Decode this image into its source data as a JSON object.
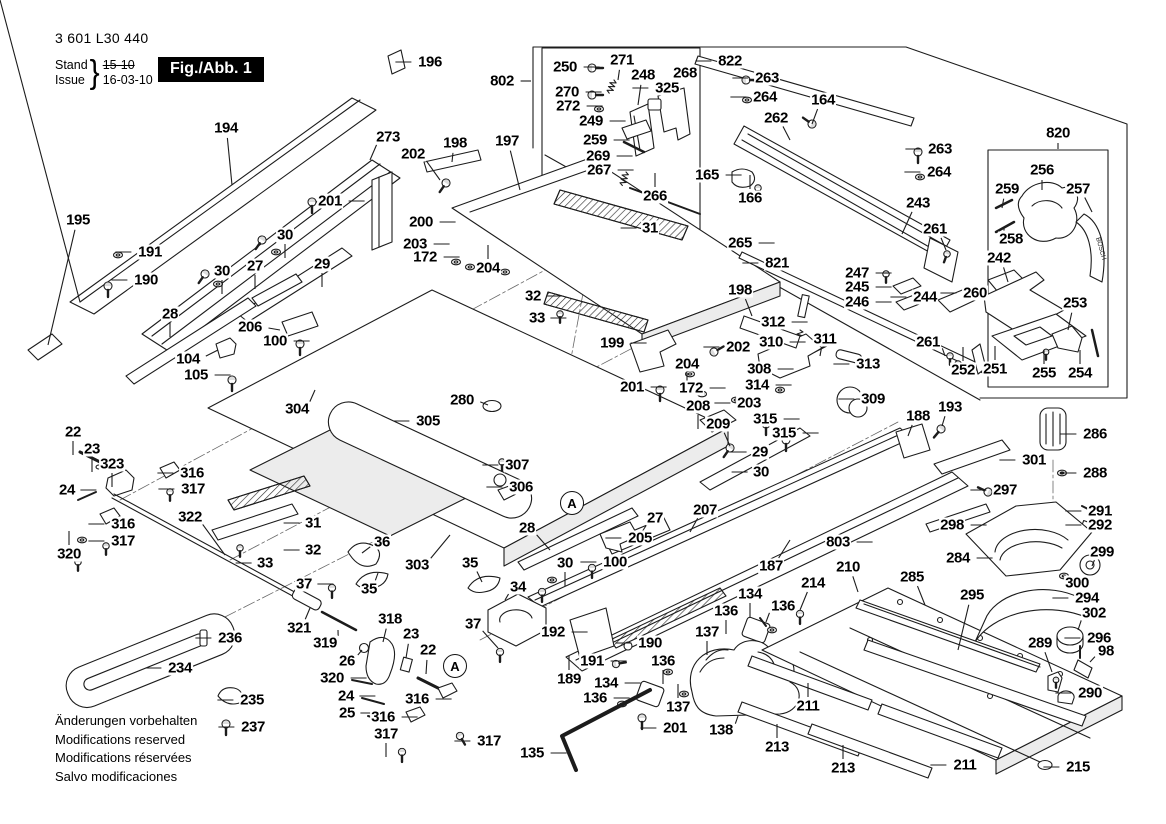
{
  "header": {
    "part_number": "3 601 L30 440",
    "stand_label": "Stand",
    "issue_label": "Issue",
    "brace": "}",
    "stand_value": "15-10",
    "issue_value": "16-03-10",
    "figure_label": "Fig./Abb. 1"
  },
  "footer": {
    "line1": "Änderungen vorbehalten",
    "line2": "Modifications reserved",
    "line3": "Modifications réservées",
    "line4": "Salvo modificaciones"
  },
  "handle_brand": "BOSCH",
  "detail_markers": [
    {
      "t": "A",
      "x": 572,
      "y": 503
    },
    {
      "t": "A",
      "x": 455,
      "y": 666
    }
  ],
  "callouts": [
    {
      "t": "194",
      "x": 226,
      "y": 128,
      "lx": 232,
      "ly": 185
    },
    {
      "t": "273",
      "x": 388,
      "y": 137,
      "lx": 370,
      "ly": 160
    },
    {
      "t": "195",
      "x": 78,
      "y": 220,
      "lx": 48,
      "ly": 345
    },
    {
      "t": "191",
      "x": 150,
      "y": 252,
      "d": "l"
    },
    {
      "t": "190",
      "x": 146,
      "y": 280,
      "d": "l"
    },
    {
      "t": "196",
      "x": 430,
      "y": 62,
      "d": "l"
    },
    {
      "t": "202",
      "x": 413,
      "y": 154,
      "lx": 440,
      "ly": 180
    },
    {
      "t": "198",
      "x": 455,
      "y": 143,
      "lx": 452,
      "ly": 162
    },
    {
      "t": "197",
      "x": 507,
      "y": 141,
      "lx": 520,
      "ly": 190
    },
    {
      "t": "802",
      "x": 502,
      "y": 81,
      "lx": 531,
      "ly": 81
    },
    {
      "t": "201",
      "x": 330,
      "y": 201,
      "d": "r"
    },
    {
      "t": "30",
      "x": 285,
      "y": 235,
      "d": "d"
    },
    {
      "t": "27",
      "x": 255,
      "y": 266,
      "d": "d"
    },
    {
      "t": "29",
      "x": 322,
      "y": 264,
      "d": "d"
    },
    {
      "t": "200",
      "x": 421,
      "y": 222,
      "d": "r"
    },
    {
      "t": "203",
      "x": 415,
      "y": 244,
      "d": "r"
    },
    {
      "t": "172",
      "x": 425,
      "y": 257,
      "d": "r"
    },
    {
      "t": "204",
      "x": 488,
      "y": 268,
      "d": "u"
    },
    {
      "t": "30",
      "x": 222,
      "y": 271,
      "d": "d"
    },
    {
      "t": "28",
      "x": 170,
      "y": 314,
      "d": "d"
    },
    {
      "t": "206",
      "x": 250,
      "y": 327,
      "lx": 280,
      "ly": 330
    },
    {
      "t": "100",
      "x": 275,
      "y": 341,
      "d": "r"
    },
    {
      "t": "104",
      "x": 188,
      "y": 359,
      "lx": 218,
      "ly": 350
    },
    {
      "t": "105",
      "x": 196,
      "y": 375,
      "d": "r"
    },
    {
      "t": "304",
      "x": 297,
      "y": 409,
      "lx": 315,
      "ly": 390
    },
    {
      "t": "305",
      "x": 428,
      "y": 421,
      "d": "l"
    },
    {
      "t": "280",
      "x": 462,
      "y": 400,
      "lx": 488,
      "ly": 405
    },
    {
      "t": "307",
      "x": 517,
      "y": 465,
      "d": "l"
    },
    {
      "t": "306",
      "x": 521,
      "y": 487,
      "d": "l"
    },
    {
      "t": "303",
      "x": 417,
      "y": 565,
      "lx": 450,
      "ly": 535
    },
    {
      "t": "322",
      "x": 190,
      "y": 517,
      "lx": 225,
      "ly": 555
    },
    {
      "t": "323",
      "x": 112,
      "y": 464,
      "d": "d"
    },
    {
      "t": "22",
      "x": 73,
      "y": 432,
      "d": "d"
    },
    {
      "t": "23",
      "x": 92,
      "y": 449,
      "d": "d"
    },
    {
      "t": "24",
      "x": 67,
      "y": 490,
      "d": "r"
    },
    {
      "t": "316",
      "x": 192,
      "y": 473,
      "d": "l"
    },
    {
      "t": "317",
      "x": 193,
      "y": 489,
      "d": "l"
    },
    {
      "t": "316",
      "x": 123,
      "y": 524,
      "d": "l"
    },
    {
      "t": "317",
      "x": 123,
      "y": 541,
      "d": "l"
    },
    {
      "t": "320",
      "x": 69,
      "y": 554,
      "d": "u"
    },
    {
      "t": "31",
      "x": 313,
      "y": 523,
      "d": "l"
    },
    {
      "t": "32",
      "x": 313,
      "y": 550,
      "d": "l"
    },
    {
      "t": "33",
      "x": 265,
      "y": 563,
      "d": "l"
    },
    {
      "t": "36",
      "x": 382,
      "y": 542,
      "lx": 362,
      "ly": 553
    },
    {
      "t": "35",
      "x": 369,
      "y": 589,
      "lx": 378,
      "ly": 573
    },
    {
      "t": "37",
      "x": 304,
      "y": 584,
      "d": "r"
    },
    {
      "t": "321",
      "x": 299,
      "y": 628,
      "lx": 310,
      "ly": 608
    },
    {
      "t": "319",
      "x": 325,
      "y": 643,
      "lx": 338,
      "ly": 630
    },
    {
      "t": "26",
      "x": 347,
      "y": 661,
      "lx": 362,
      "ly": 650
    },
    {
      "t": "318",
      "x": 390,
      "y": 619,
      "lx": 383,
      "ly": 642
    },
    {
      "t": "23",
      "x": 411,
      "y": 634,
      "lx": 406,
      "ly": 658
    },
    {
      "t": "22",
      "x": 428,
      "y": 650,
      "lx": 426,
      "ly": 674
    },
    {
      "t": "320",
      "x": 332,
      "y": 678,
      "d": "r"
    },
    {
      "t": "24",
      "x": 346,
      "y": 696,
      "d": "r"
    },
    {
      "t": "25",
      "x": 347,
      "y": 713,
      "d": "r"
    },
    {
      "t": "316",
      "x": 417,
      "y": 699,
      "d": "r"
    },
    {
      "t": "316",
      "x": 383,
      "y": 717,
      "d": "r"
    },
    {
      "t": "317",
      "x": 386,
      "y": 734,
      "d": "d"
    },
    {
      "t": "317",
      "x": 489,
      "y": 741,
      "d": "l"
    },
    {
      "t": "37",
      "x": 473,
      "y": 624,
      "lx": 498,
      "ly": 648
    },
    {
      "t": "236",
      "x": 230,
      "y": 638,
      "d": "l"
    },
    {
      "t": "234",
      "x": 180,
      "y": 668,
      "d": "l"
    },
    {
      "t": "235",
      "x": 252,
      "y": 700,
      "d": "l"
    },
    {
      "t": "237",
      "x": 253,
      "y": 727,
      "d": "l"
    },
    {
      "t": "34",
      "x": 518,
      "y": 587,
      "lx": 505,
      "ly": 600
    },
    {
      "t": "35",
      "x": 470,
      "y": 563,
      "lx": 482,
      "ly": 582
    },
    {
      "t": "192",
      "x": 553,
      "y": 632,
      "d": "r"
    },
    {
      "t": "190",
      "x": 650,
      "y": 643,
      "d": "l"
    },
    {
      "t": "191",
      "x": 592,
      "y": 661,
      "d": "r"
    },
    {
      "t": "189",
      "x": 569,
      "y": 679,
      "d": "u"
    },
    {
      "t": "135",
      "x": 532,
      "y": 753,
      "d": "r"
    },
    {
      "t": "134",
      "x": 606,
      "y": 683,
      "d": "r"
    },
    {
      "t": "136",
      "x": 595,
      "y": 698,
      "d": "r"
    },
    {
      "t": "137",
      "x": 678,
      "y": 707,
      "d": "u"
    },
    {
      "t": "201",
      "x": 675,
      "y": 728,
      "d": "l"
    },
    {
      "t": "136",
      "x": 663,
      "y": 661,
      "d": "d"
    },
    {
      "t": "138",
      "x": 721,
      "y": 730,
      "lx": 738,
      "ly": 716
    },
    {
      "t": "134",
      "x": 750,
      "y": 594,
      "d": "d"
    },
    {
      "t": "136",
      "x": 783,
      "y": 606,
      "lx": 766,
      "ly": 622
    },
    {
      "t": "136",
      "x": 726,
      "y": 611,
      "d": "d"
    },
    {
      "t": "137",
      "x": 707,
      "y": 632,
      "d": "d"
    },
    {
      "t": "28",
      "x": 527,
      "y": 528,
      "lx": 550,
      "ly": 550
    },
    {
      "t": "205",
      "x": 640,
      "y": 538,
      "d": "l"
    },
    {
      "t": "27",
      "x": 655,
      "y": 518,
      "lx": 640,
      "ly": 535
    },
    {
      "t": "100",
      "x": 615,
      "y": 562,
      "d": "l"
    },
    {
      "t": "30",
      "x": 565,
      "y": 563,
      "d": "d"
    },
    {
      "t": "207",
      "x": 705,
      "y": 510,
      "lx": 690,
      "ly": 532
    },
    {
      "t": "187",
      "x": 771,
      "y": 566,
      "lx": 790,
      "ly": 540
    },
    {
      "t": "803",
      "x": 838,
      "y": 542,
      "d": "r"
    },
    {
      "t": "210",
      "x": 848,
      "y": 567,
      "lx": 858,
      "ly": 592
    },
    {
      "t": "214",
      "x": 813,
      "y": 583,
      "lx": 800,
      "ly": 610
    },
    {
      "t": "211",
      "x": 808,
      "y": 706,
      "d": "u"
    },
    {
      "t": "213",
      "x": 777,
      "y": 747,
      "d": "u"
    },
    {
      "t": "213",
      "x": 843,
      "y": 768,
      "d": "u"
    },
    {
      "t": "211",
      "x": 965,
      "y": 765,
      "d": "l"
    },
    {
      "t": "215",
      "x": 1078,
      "y": 767,
      "d": "l"
    },
    {
      "t": "285",
      "x": 912,
      "y": 577,
      "lx": 925,
      "ly": 605
    },
    {
      "t": "295",
      "x": 972,
      "y": 595,
      "lx": 958,
      "ly": 650
    },
    {
      "t": "284",
      "x": 958,
      "y": 558,
      "d": "r"
    },
    {
      "t": "297",
      "x": 1005,
      "y": 490,
      "d": "l"
    },
    {
      "t": "298",
      "x": 952,
      "y": 525,
      "d": "r"
    },
    {
      "t": "291",
      "x": 1100,
      "y": 511,
      "d": "l"
    },
    {
      "t": "292",
      "x": 1100,
      "y": 525,
      "d": "l"
    },
    {
      "t": "299",
      "x": 1102,
      "y": 552,
      "lx": 1092,
      "ly": 566
    },
    {
      "t": "300",
      "x": 1077,
      "y": 583,
      "lx": 1068,
      "ly": 576
    },
    {
      "t": "294",
      "x": 1087,
      "y": 598,
      "d": "l"
    },
    {
      "t": "302",
      "x": 1094,
      "y": 613,
      "lx": 1078,
      "ly": 630
    },
    {
      "t": "296",
      "x": 1099,
      "y": 638,
      "d": "l"
    },
    {
      "t": "98",
      "x": 1106,
      "y": 651,
      "lx": 1090,
      "ly": 662
    },
    {
      "t": "289",
      "x": 1040,
      "y": 643,
      "lx": 1052,
      "ly": 672
    },
    {
      "t": "290",
      "x": 1090,
      "y": 693,
      "d": "l"
    },
    {
      "t": "286",
      "x": 1095,
      "y": 434,
      "d": "l"
    },
    {
      "t": "288",
      "x": 1095,
      "y": 473,
      "d": "l"
    },
    {
      "t": "301",
      "x": 1034,
      "y": 460,
      "d": "l"
    },
    {
      "t": "188",
      "x": 918,
      "y": 416,
      "lx": 908,
      "ly": 436
    },
    {
      "t": "193",
      "x": 950,
      "y": 407,
      "lx": 942,
      "ly": 426
    },
    {
      "t": "308",
      "x": 759,
      "y": 369,
      "d": "r"
    },
    {
      "t": "314",
      "x": 757,
      "y": 385,
      "d": "r"
    },
    {
      "t": "312",
      "x": 773,
      "y": 322,
      "d": "r"
    },
    {
      "t": "310",
      "x": 771,
      "y": 342,
      "d": "r"
    },
    {
      "t": "311",
      "x": 825,
      "y": 339,
      "lx": 820,
      "ly": 356
    },
    {
      "t": "313",
      "x": 868,
      "y": 364,
      "d": "l"
    },
    {
      "t": "309",
      "x": 873,
      "y": 399,
      "d": "l"
    },
    {
      "t": "315",
      "x": 765,
      "y": 419,
      "d": "r"
    },
    {
      "t": "315",
      "x": 784,
      "y": 433,
      "d": "r"
    },
    {
      "t": "29",
      "x": 760,
      "y": 452,
      "d": "l"
    },
    {
      "t": "30",
      "x": 761,
      "y": 472,
      "d": "l"
    },
    {
      "t": "203",
      "x": 749,
      "y": 403,
      "d": "l"
    },
    {
      "t": "202",
      "x": 738,
      "y": 347,
      "d": "l"
    },
    {
      "t": "198",
      "x": 740,
      "y": 290,
      "lx": 752,
      "ly": 316
    },
    {
      "t": "208",
      "x": 698,
      "y": 406,
      "d": "d"
    },
    {
      "t": "209",
      "x": 718,
      "y": 424,
      "lx": 730,
      "ly": 446
    },
    {
      "t": "201",
      "x": 632,
      "y": 387,
      "d": "r"
    },
    {
      "t": "204",
      "x": 687,
      "y": 364,
      "d": "d"
    },
    {
      "t": "172",
      "x": 691,
      "y": 388,
      "d": "r"
    },
    {
      "t": "199",
      "x": 612,
      "y": 343,
      "d": "r"
    },
    {
      "t": "31",
      "x": 650,
      "y": 228,
      "d": "l"
    },
    {
      "t": "32",
      "x": 533,
      "y": 296,
      "d": "r"
    },
    {
      "t": "33",
      "x": 537,
      "y": 318,
      "d": "r"
    },
    {
      "t": "265",
      "x": 740,
      "y": 243,
      "d": "r"
    },
    {
      "t": "821",
      "x": 777,
      "y": 263,
      "d": "l"
    },
    {
      "t": "822",
      "x": 730,
      "y": 61,
      "d": "l"
    },
    {
      "t": "263",
      "x": 767,
      "y": 78,
      "d": "l"
    },
    {
      "t": "264",
      "x": 765,
      "y": 97,
      "d": "l"
    },
    {
      "t": "164",
      "x": 823,
      "y": 100,
      "lx": 812,
      "ly": 124
    },
    {
      "t": "262",
      "x": 776,
      "y": 118,
      "lx": 790,
      "ly": 140
    },
    {
      "t": "263",
      "x": 940,
      "y": 149,
      "d": "l"
    },
    {
      "t": "264",
      "x": 939,
      "y": 172,
      "d": "l"
    },
    {
      "t": "243",
      "x": 918,
      "y": 203,
      "lx": 902,
      "ly": 234
    },
    {
      "t": "261",
      "x": 935,
      "y": 229,
      "lx": 946,
      "ly": 250
    },
    {
      "t": "247",
      "x": 857,
      "y": 273,
      "d": "r"
    },
    {
      "t": "245",
      "x": 857,
      "y": 287,
      "d": "r"
    },
    {
      "t": "246",
      "x": 857,
      "y": 302,
      "d": "r"
    },
    {
      "t": "244",
      "x": 925,
      "y": 297,
      "d": "l"
    },
    {
      "t": "260",
      "x": 975,
      "y": 293,
      "d": "l"
    },
    {
      "t": "261",
      "x": 928,
      "y": 342,
      "lx": 945,
      "ly": 356
    },
    {
      "t": "252",
      "x": 963,
      "y": 370,
      "d": "u"
    },
    {
      "t": "251",
      "x": 995,
      "y": 369,
      "d": "u"
    },
    {
      "t": "255",
      "x": 1044,
      "y": 373,
      "d": "u"
    },
    {
      "t": "254",
      "x": 1080,
      "y": 373,
      "d": "u"
    },
    {
      "t": "253",
      "x": 1075,
      "y": 303,
      "lx": 1068,
      "ly": 330
    },
    {
      "t": "242",
      "x": 999,
      "y": 258,
      "lx": 1008,
      "ly": 282
    },
    {
      "t": "256",
      "x": 1042,
      "y": 170,
      "lx": 1042,
      "ly": 190
    },
    {
      "t": "257",
      "x": 1078,
      "y": 189,
      "lx": 1092,
      "ly": 212
    },
    {
      "t": "259",
      "x": 1007,
      "y": 189,
      "lx": 1002,
      "ly": 208
    },
    {
      "t": "258",
      "x": 1011,
      "y": 239,
      "lx": 1004,
      "ly": 228
    },
    {
      "t": "820",
      "x": 1058,
      "y": 133,
      "lx": 1058,
      "ly": 149
    },
    {
      "t": "250",
      "x": 565,
      "y": 67,
      "d": "r"
    },
    {
      "t": "271",
      "x": 622,
      "y": 60,
      "lx": 618,
      "ly": 80
    },
    {
      "t": "248",
      "x": 643,
      "y": 75,
      "lx": 638,
      "ly": 105
    },
    {
      "t": "268",
      "x": 685,
      "y": 73,
      "lx": 675,
      "ly": 90
    },
    {
      "t": "325",
      "x": 667,
      "y": 88,
      "d": "l"
    },
    {
      "t": "270",
      "x": 567,
      "y": 92,
      "d": "r"
    },
    {
      "t": "272",
      "x": 568,
      "y": 106,
      "d": "r"
    },
    {
      "t": "249",
      "x": 591,
      "y": 121,
      "d": "r"
    },
    {
      "t": "259",
      "x": 595,
      "y": 140,
      "d": "r"
    },
    {
      "t": "269",
      "x": 598,
      "y": 156,
      "d": "r"
    },
    {
      "t": "267",
      "x": 599,
      "y": 170,
      "d": "r"
    },
    {
      "t": "266",
      "x": 655,
      "y": 196,
      "d": "u"
    },
    {
      "t": "165",
      "x": 707,
      "y": 175,
      "d": "r"
    },
    {
      "t": "166",
      "x": 750,
      "y": 198,
      "d": "u"
    }
  ]
}
